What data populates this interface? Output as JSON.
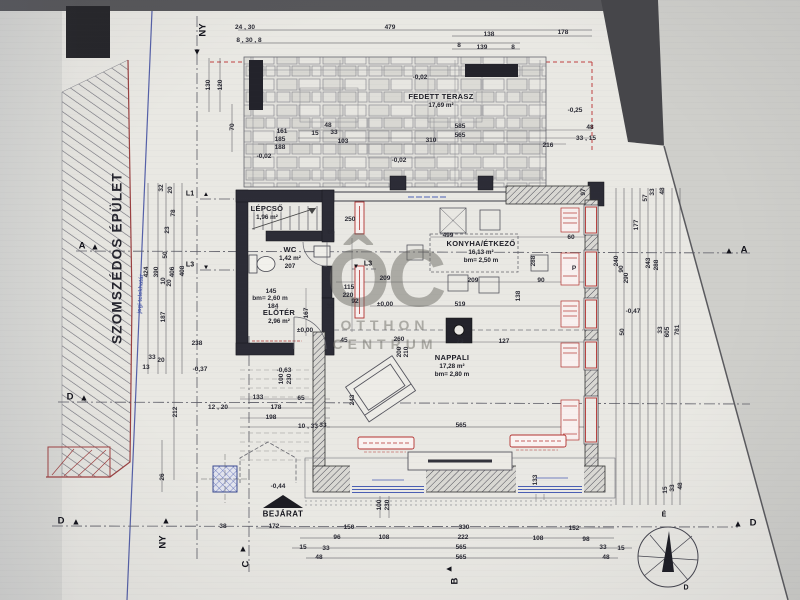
{
  "watermark": {
    "monogram": "ÔC",
    "line1": "OTTHON",
    "line2": "CENTRUM"
  },
  "neighbor_label": "SZOMSZÉDOS ÉPÜLET",
  "boundary_label": "jogi telekhatár",
  "entrance_label": "BEJÁRAT",
  "rooms": [
    {
      "n": "LÉPCSŐ",
      "a": "1,96 m²",
      "x": 267,
      "y": 213
    },
    {
      "n": "WC",
      "a": "1,42 m²",
      "h": "207",
      "x": 290,
      "y": 258
    },
    {
      "n": "ELŐTÉR",
      "a": "2,96 m²",
      "x": 279,
      "y": 317
    },
    {
      "n": "KONYHA/ÉTKEZŐ",
      "a": "16,13 m²",
      "h": "bm= 2,50 m",
      "x": 481,
      "y": 252
    },
    {
      "n": "NAPPALI",
      "a": "17,28 m²",
      "h": "bm= 2,80 m",
      "x": 452,
      "y": 366
    },
    {
      "n": "FEDETT TERASZ",
      "a": "17,69 m²",
      "x": 441,
      "y": 101
    }
  ],
  "markers": [
    {
      "l": "NY",
      "x": 203,
      "y": 30,
      "lr": -90,
      "tri": {
        "x": 197,
        "y": 52,
        "r": 180
      }
    },
    {
      "l": "NY",
      "x": 163,
      "y": 542,
      "lr": -90,
      "tri": {
        "x": 166,
        "y": 521,
        "r": 0
      }
    },
    {
      "l": "A",
      "x": 82,
      "y": 246,
      "tri": {
        "x": 95,
        "y": 247,
        "r": 0
      }
    },
    {
      "l": "D",
      "x": 70,
      "y": 397,
      "tri": {
        "x": 84,
        "y": 398,
        "r": 0
      }
    },
    {
      "l": "D",
      "x": 61,
      "y": 521,
      "tri": {
        "x": 76,
        "y": 522,
        "r": 0
      }
    },
    {
      "l": "A",
      "x": 744,
      "y": 250,
      "tri": {
        "x": 729,
        "y": 251,
        "r": 0
      }
    },
    {
      "l": "D",
      "x": 753,
      "y": 523,
      "tri": {
        "x": 738,
        "y": 524,
        "r": 0
      }
    },
    {
      "l": "C",
      "x": 246,
      "y": 564,
      "lr": -90,
      "tri": {
        "x": 243,
        "y": 549,
        "r": 0
      }
    },
    {
      "l": "B",
      "x": 455,
      "y": 581,
      "lr": -90,
      "tri": {
        "x": 449,
        "y": 569,
        "r": -90
      }
    },
    {
      "l": "L1",
      "x": 190,
      "y": 194,
      "sm": 1,
      "tri": {
        "x": 206,
        "y": 195,
        "r": 0,
        "sm": 1
      }
    },
    {
      "l": "L3",
      "x": 190,
      "y": 265,
      "sm": 1,
      "tri": {
        "x": 206,
        "y": 266,
        "r": 180,
        "sm": 1
      }
    },
    {
      "l": "L3",
      "x": 368,
      "y": 264,
      "sm": 1,
      "tri": {
        "x": 356,
        "y": 265,
        "r": 180,
        "sm": 1
      }
    },
    {
      "l": "É",
      "x": 664,
      "y": 515,
      "sm": 1
    },
    {
      "l": "D",
      "x": 686,
      "y": 588,
      "sm": 1
    }
  ],
  "dims": [
    {
      "t": "24 , 30",
      "x": 245,
      "y": 28
    },
    {
      "t": "8 , 30 , 8",
      "x": 249,
      "y": 41
    },
    {
      "t": "479",
      "x": 390,
      "y": 28
    },
    {
      "t": "138",
      "x": 489,
      "y": 35
    },
    {
      "t": "8",
      "x": 459,
      "y": 46
    },
    {
      "t": "139",
      "x": 482,
      "y": 48
    },
    {
      "t": "8",
      "x": 513,
      "y": 48
    },
    {
      "t": "178",
      "x": 563,
      "y": 33
    },
    {
      "t": "-0,25",
      "x": 575,
      "y": 111
    },
    {
      "t": "-0,02",
      "x": 420,
      "y": 78
    },
    {
      "t": "161",
      "x": 282,
      "y": 132
    },
    {
      "t": "185",
      "x": 280,
      "y": 140
    },
    {
      "t": "188",
      "x": 280,
      "y": 148
    },
    {
      "t": "70",
      "x": 233,
      "y": 127,
      "r": -90
    },
    {
      "t": "130",
      "x": 209,
      "y": 85,
      "r": -90
    },
    {
      "t": "120",
      "x": 221,
      "y": 85,
      "r": -90
    },
    {
      "t": "48",
      "x": 328,
      "y": 126
    },
    {
      "t": "33",
      "x": 334,
      "y": 133
    },
    {
      "t": "15",
      "x": 315,
      "y": 134
    },
    {
      "t": "103",
      "x": 343,
      "y": 142
    },
    {
      "t": "310",
      "x": 431,
      "y": 141
    },
    {
      "t": "585",
      "x": 460,
      "y": 127
    },
    {
      "t": "565",
      "x": 460,
      "y": 136
    },
    {
      "t": "216",
      "x": 548,
      "y": 146
    },
    {
      "t": "33 , 15",
      "x": 586,
      "y": 139
    },
    {
      "t": "48",
      "x": 590,
      "y": 128
    },
    {
      "t": "-0,02",
      "x": 264,
      "y": 157
    },
    {
      "t": "-0,02",
      "x": 399,
      "y": 161
    },
    {
      "t": "424",
      "x": 147,
      "y": 272,
      "r": -90
    },
    {
      "t": "390",
      "x": 157,
      "y": 272,
      "r": -90
    },
    {
      "t": "406",
      "x": 173,
      "y": 272,
      "r": -90
    },
    {
      "t": "408",
      "x": 183,
      "y": 271,
      "r": -90
    },
    {
      "t": "187",
      "x": 164,
      "y": 317,
      "r": -90
    },
    {
      "t": "32",
      "x": 162,
      "y": 188,
      "r": -90
    },
    {
      "t": "20",
      "x": 171,
      "y": 190,
      "r": -90
    },
    {
      "t": "78",
      "x": 174,
      "y": 213,
      "r": -90
    },
    {
      "t": "23",
      "x": 168,
      "y": 230,
      "r": -90
    },
    {
      "t": "50",
      "x": 166,
      "y": 255,
      "r": -90
    },
    {
      "t": "10",
      "x": 164,
      "y": 281,
      "r": -90
    },
    {
      "t": "20",
      "x": 170,
      "y": 283,
      "r": -90
    },
    {
      "t": "238",
      "x": 197,
      "y": 344
    },
    {
      "t": "33",
      "x": 152,
      "y": 358
    },
    {
      "t": "20",
      "x": 161,
      "y": 361
    },
    {
      "t": "13",
      "x": 146,
      "y": 368
    },
    {
      "t": "-0,37",
      "x": 200,
      "y": 370
    },
    {
      "t": "212",
      "x": 176,
      "y": 412,
      "r": -90
    },
    {
      "t": "26",
      "x": 163,
      "y": 477,
      "r": -90
    },
    {
      "t": "38",
      "x": 223,
      "y": 527
    },
    {
      "t": "250",
      "x": 350,
      "y": 220
    },
    {
      "t": "65",
      "x": 331,
      "y": 233
    },
    {
      "t": "145",
      "x": 271,
      "y": 292
    },
    {
      "t": "bm= 2,60 m",
      "x": 270,
      "y": 299
    },
    {
      "t": "184",
      "x": 273,
      "y": 307
    },
    {
      "t": "33",
      "x": 330,
      "y": 307
    },
    {
      "t": "167",
      "x": 307,
      "y": 313,
      "r": -90
    },
    {
      "t": "115",
      "x": 349,
      "y": 288
    },
    {
      "t": "220",
      "x": 348,
      "y": 296
    },
    {
      "t": "92",
      "x": 355,
      "y": 302
    },
    {
      "t": "±0,00",
      "x": 305,
      "y": 331
    },
    {
      "t": "±0,00",
      "x": 385,
      "y": 305
    },
    {
      "t": "209",
      "x": 385,
      "y": 279
    },
    {
      "t": "-0,63",
      "x": 284,
      "y": 371
    },
    {
      "t": "100",
      "x": 282,
      "y": 379,
      "r": -90
    },
    {
      "t": "230",
      "x": 290,
      "y": 379,
      "r": -90
    },
    {
      "t": "133",
      "x": 258,
      "y": 398
    },
    {
      "t": "65",
      "x": 301,
      "y": 399
    },
    {
      "t": "178",
      "x": 276,
      "y": 408
    },
    {
      "t": "198",
      "x": 271,
      "y": 418
    },
    {
      "t": "12 , 20",
      "x": 218,
      "y": 408
    },
    {
      "t": "10 , 33",
      "x": 308,
      "y": 427
    },
    {
      "t": "-0,44",
      "x": 278,
      "y": 487
    },
    {
      "t": "499",
      "x": 448,
      "y": 236
    },
    {
      "t": "209",
      "x": 473,
      "y": 281
    },
    {
      "t": "519",
      "x": 460,
      "y": 305
    },
    {
      "t": "60",
      "x": 571,
      "y": 238
    },
    {
      "t": "90",
      "x": 541,
      "y": 281
    },
    {
      "t": "138",
      "x": 519,
      "y": 296,
      "r": -90
    },
    {
      "t": "288",
      "x": 534,
      "y": 261,
      "r": -90
    },
    {
      "t": "P",
      "x": 574,
      "y": 269
    },
    {
      "t": "45",
      "x": 344,
      "y": 341
    },
    {
      "t": "260",
      "x": 399,
      "y": 340
    },
    {
      "t": "200",
      "x": 400,
      "y": 352,
      "r": -90
    },
    {
      "t": "210",
      "x": 407,
      "y": 352,
      "r": -90
    },
    {
      "t": "73",
      "x": 460,
      "y": 342
    },
    {
      "t": "127",
      "x": 504,
      "y": 342
    },
    {
      "t": "243",
      "x": 353,
      "y": 400,
      "r": -90
    },
    {
      "t": "33",
      "x": 323,
      "y": 426
    },
    {
      "t": "565",
      "x": 461,
      "y": 426
    },
    {
      "t": "97",
      "x": 584,
      "y": 192,
      "r": -90
    },
    {
      "t": "57",
      "x": 646,
      "y": 198,
      "r": -90
    },
    {
      "t": "33",
      "x": 653,
      "y": 192,
      "r": -90
    },
    {
      "t": "48",
      "x": 663,
      "y": 191,
      "r": -90
    },
    {
      "t": "177",
      "x": 637,
      "y": 225,
      "r": -90
    },
    {
      "t": "240",
      "x": 617,
      "y": 261,
      "r": -90
    },
    {
      "t": "90",
      "x": 622,
      "y": 269,
      "r": -90
    },
    {
      "t": "290",
      "x": 627,
      "y": 278,
      "r": -90
    },
    {
      "t": "243",
      "x": 649,
      "y": 263,
      "r": -90
    },
    {
      "t": "288",
      "x": 657,
      "y": 265,
      "r": -90
    },
    {
      "t": "-0,47",
      "x": 633,
      "y": 312
    },
    {
      "t": "50",
      "x": 623,
      "y": 332,
      "r": -90
    },
    {
      "t": "33",
      "x": 661,
      "y": 330,
      "r": -90
    },
    {
      "t": "605",
      "x": 668,
      "y": 332,
      "r": -90
    },
    {
      "t": "781",
      "x": 678,
      "y": 330,
      "r": -90
    },
    {
      "t": "15",
      "x": 666,
      "y": 490,
      "r": -90
    },
    {
      "t": "33",
      "x": 673,
      "y": 488,
      "r": -90
    },
    {
      "t": "48",
      "x": 681,
      "y": 486,
      "r": -90
    },
    {
      "t": "172",
      "x": 274,
      "y": 527
    },
    {
      "t": "150",
      "x": 349,
      "y": 528
    },
    {
      "t": "330",
      "x": 464,
      "y": 528
    },
    {
      "t": "152",
      "x": 574,
      "y": 529
    },
    {
      "t": "96",
      "x": 337,
      "y": 538
    },
    {
      "t": "108",
      "x": 384,
      "y": 538
    },
    {
      "t": "222",
      "x": 463,
      "y": 538
    },
    {
      "t": "108",
      "x": 538,
      "y": 539
    },
    {
      "t": "98",
      "x": 586,
      "y": 540
    },
    {
      "t": "15",
      "x": 303,
      "y": 548
    },
    {
      "t": "33",
      "x": 326,
      "y": 549
    },
    {
      "t": "565",
      "x": 461,
      "y": 548
    },
    {
      "t": "33",
      "x": 603,
      "y": 548
    },
    {
      "t": "15",
      "x": 621,
      "y": 549
    },
    {
      "t": "48",
      "x": 319,
      "y": 558
    },
    {
      "t": "565",
      "x": 461,
      "y": 558
    },
    {
      "t": "48",
      "x": 606,
      "y": 558
    },
    {
      "t": "100",
      "x": 380,
      "y": 505,
      "r": -90
    },
    {
      "t": "230",
      "x": 388,
      "y": 505,
      "r": -90
    },
    {
      "t": "133",
      "x": 536,
      "y": 480,
      "r": -90
    }
  ]
}
